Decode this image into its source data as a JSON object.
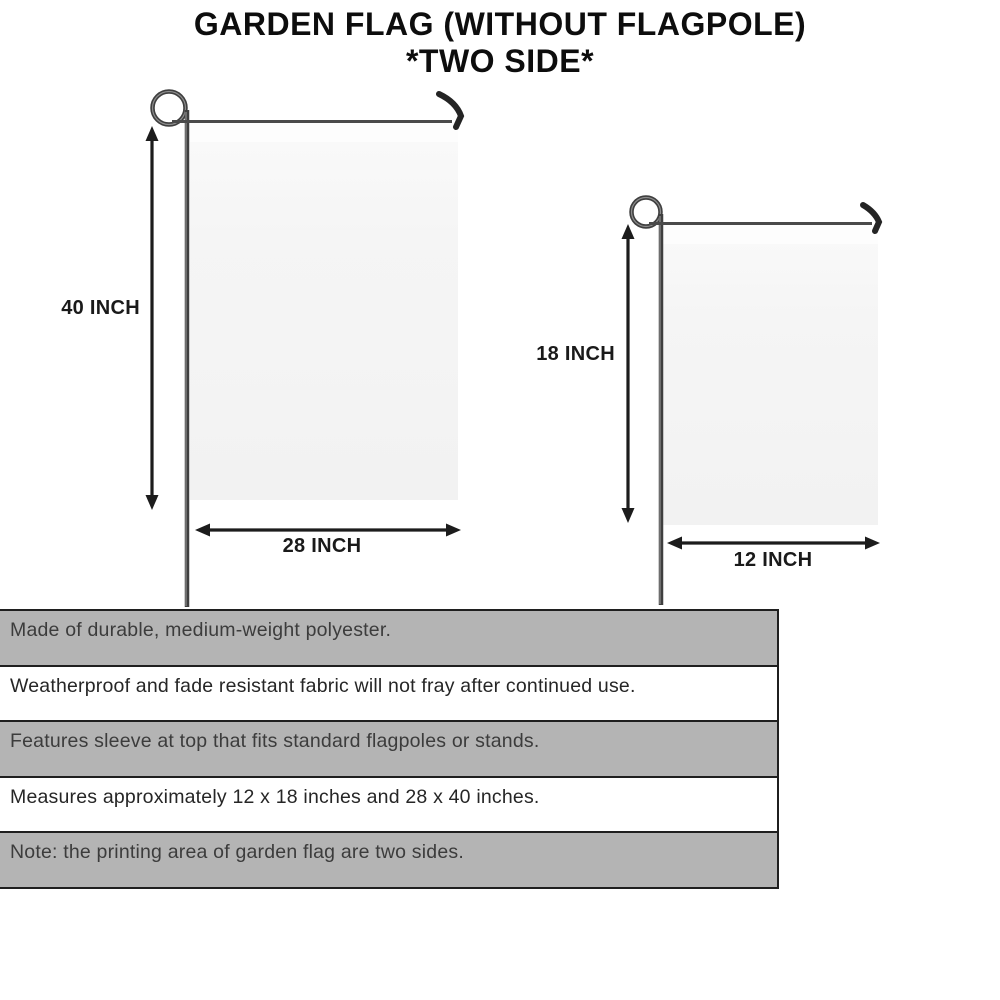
{
  "title": {
    "line1": "GARDEN FLAG (WITHOUT FLAGPOLE)",
    "line2": "*TWO SIDE*"
  },
  "flags": {
    "large": {
      "height_label": "40 INCH",
      "width_label": "28 INCH"
    },
    "small": {
      "height_label": "18 INCH",
      "width_label": "12 INCH"
    }
  },
  "features": [
    "Made of durable, medium-weight polyester.",
    "Weatherproof and fade resistant fabric will not fray after continued use.",
    "Features sleeve at top that fits standard flagpoles or stands.",
    "Measures approximately 12 x 18 inches and 28 x 40 inches.",
    "Note: the printing area of garden flag are two sides."
  ],
  "colors": {
    "title_text": "#0d0d0d",
    "pole": "#3f3f3f",
    "arrow": "#1c1c1c",
    "fabric": "#f4f4f4",
    "table_shaded_row": "#b4b4b4",
    "table_border": "#1f1f1f"
  }
}
